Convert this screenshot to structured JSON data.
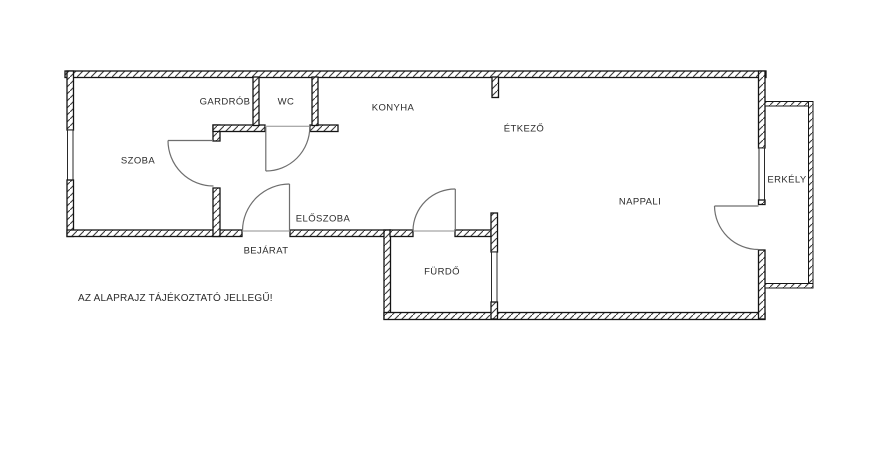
{
  "rooms": {
    "szoba": "SZOBA",
    "gardrob": "GARDRÓB",
    "wc": "WC",
    "konyha": "KONYHA",
    "etkezo": "ÉTKEZŐ",
    "eloszoba": "ELŐSZOBA",
    "bejarat": "BEJÁRAT",
    "furdo": "FÜRDŐ",
    "nappali": "NAPPALI",
    "erkely": "ERKÉLY"
  },
  "disclaimer": "AZ ALAPRAJZ TÁJÉKOZTATÓ JELLEGŰ!",
  "colors": {
    "background": "#ffffff",
    "wall_line": "#141414",
    "hatch_line": "#3a3a3a",
    "door_line": "#6e6e6e",
    "label_text": "#2b2b2b"
  }
}
